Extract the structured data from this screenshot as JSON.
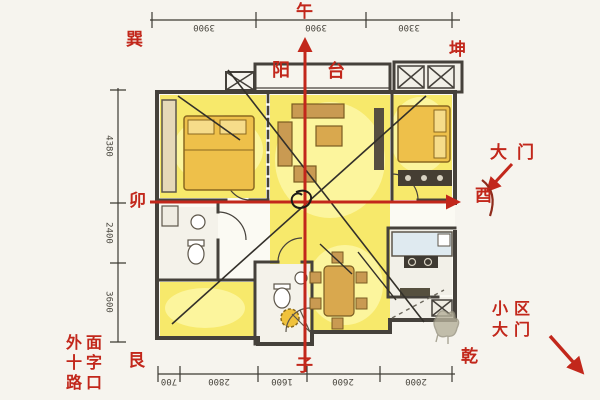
{
  "palette": {
    "annotation_red": "#c2271b",
    "dark_red_arc": "#8f2c1c",
    "wall_dark": "#45413b",
    "room_yellow": "#f7e96b",
    "room_highlight": "#fef8ae",
    "paper": "#f6f4ee",
    "furniture_tan": "#eec04a",
    "counter_blue": "#dfeaf0"
  },
  "compass": {
    "top_left": "巽",
    "top": "午",
    "top_right": "坤",
    "left": "卯",
    "right": "酉",
    "bottom_left": "艮",
    "bottom": "子",
    "bottom_right": "乾"
  },
  "annotations": {
    "balcony_char_1": "阳",
    "balcony_char_2": "台",
    "main_door": "大门",
    "community_gate_line_1": "小区",
    "community_gate_line_2": "大门",
    "crossroad_line_1": "外面",
    "crossroad_line_2": "十字",
    "crossroad_line_3": "路口"
  },
  "dimensions": {
    "top": [
      "3900",
      "3900",
      "3300"
    ],
    "left": [
      "4380",
      "2400",
      "3600"
    ],
    "bottom": [
      "700",
      "2800",
      "1600",
      "2600",
      "2000"
    ]
  }
}
